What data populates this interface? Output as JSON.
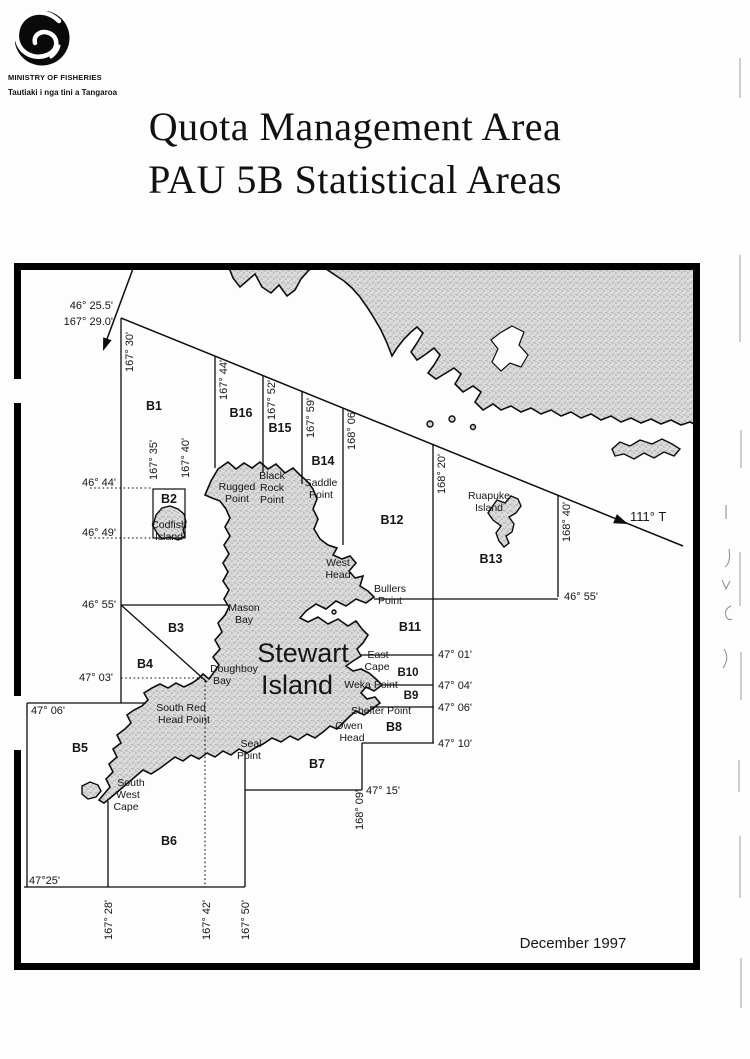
{
  "header": {
    "ministry": "MINISTRY OF FISHERIES",
    "tagline": "Tautiaki i nga tini a Tangaroa"
  },
  "title": {
    "line1": "Quota Management Area",
    "line2": "PAU 5B Statistical Areas"
  },
  "map": {
    "date": "December 1997",
    "bearing_label": "111° T",
    "origin_point": {
      "lat": "46° 25.5'",
      "lon": "167° 29.0'"
    },
    "island_title": "Stewart Island",
    "area_labels": [
      {
        "t": "B1",
        "x": 154,
        "y": 410
      },
      {
        "t": "B2",
        "x": 169,
        "y": 503
      },
      {
        "t": "B3",
        "x": 176,
        "y": 632
      },
      {
        "t": "B4",
        "x": 145,
        "y": 668
      },
      {
        "t": "B5",
        "x": 80,
        "y": 752
      },
      {
        "t": "B6",
        "x": 169,
        "y": 845
      },
      {
        "t": "B7",
        "x": 317,
        "y": 768
      },
      {
        "t": "B8",
        "x": 394,
        "y": 731
      },
      {
        "t": "B9",
        "x": 411,
        "y": 699,
        "size": 11.5
      },
      {
        "t": "B10",
        "x": 408,
        "y": 676,
        "size": 11.5
      },
      {
        "t": "B11",
        "x": 410,
        "y": 631
      },
      {
        "t": "B12",
        "x": 392,
        "y": 524
      },
      {
        "t": "B13",
        "x": 491,
        "y": 563
      },
      {
        "t": "B14",
        "x": 323,
        "y": 465
      },
      {
        "t": "B15",
        "x": 280,
        "y": 432
      },
      {
        "t": "B16",
        "x": 241,
        "y": 417
      }
    ],
    "coord_labels": [
      {
        "t": "46° 25.5'",
        "x": 113,
        "y": 309,
        "a": "end"
      },
      {
        "t": "167° 29.0'",
        "x": 113,
        "y": 325,
        "a": "end"
      },
      {
        "t": "167° 30'",
        "x": 133,
        "y": 372,
        "rot": -90
      },
      {
        "t": "167° 44'",
        "x": 227,
        "y": 400,
        "rot": -90
      },
      {
        "t": "167° 52'",
        "x": 275,
        "y": 420,
        "rot": -90
      },
      {
        "t": "167° 59'",
        "x": 314,
        "y": 438,
        "rot": -90
      },
      {
        "t": "168° 06'",
        "x": 355,
        "y": 450,
        "rot": -90
      },
      {
        "t": "168° 20'",
        "x": 445,
        "y": 494,
        "rot": -90
      },
      {
        "t": "168° 40'",
        "x": 570,
        "y": 542,
        "rot": -90
      },
      {
        "t": "167° 35'",
        "x": 157,
        "y": 480,
        "rot": -90
      },
      {
        "t": "167° 40'",
        "x": 189,
        "y": 478,
        "rot": -90
      },
      {
        "t": "46° 44'",
        "x": 116,
        "y": 486,
        "a": "end"
      },
      {
        "t": "46° 49'",
        "x": 116,
        "y": 536,
        "a": "end"
      },
      {
        "t": "46° 55'",
        "x": 116,
        "y": 608,
        "a": "end"
      },
      {
        "t": "47° 03'",
        "x": 113,
        "y": 681,
        "a": "end"
      },
      {
        "t": "47° 06'",
        "x": 31,
        "y": 714
      },
      {
        "t": "47°25'",
        "x": 29,
        "y": 884
      },
      {
        "t": "46° 55'",
        "x": 564,
        "y": 600
      },
      {
        "t": "47° 01'",
        "x": 438,
        "y": 658
      },
      {
        "t": "47° 04'",
        "x": 438,
        "y": 689
      },
      {
        "t": "47° 06'",
        "x": 438,
        "y": 711
      },
      {
        "t": "47° 10'",
        "x": 438,
        "y": 747
      },
      {
        "t": "47° 15'",
        "x": 366,
        "y": 794
      },
      {
        "t": "167° 28'",
        "x": 112,
        "y": 940,
        "rot": -90
      },
      {
        "t": "167° 42'",
        "x": 210,
        "y": 940,
        "rot": -90
      },
      {
        "t": "167° 50'",
        "x": 249,
        "y": 940,
        "rot": -90
      },
      {
        "t": "168° 09'",
        "x": 363,
        "y": 830,
        "rot": -90
      }
    ],
    "place_labels": [
      {
        "t": "Rugged",
        "x": 237,
        "y": 490
      },
      {
        "t": "Point",
        "x": 237,
        "y": 502
      },
      {
        "t": "Black",
        "x": 272,
        "y": 479
      },
      {
        "t": "Rock",
        "x": 272,
        "y": 491
      },
      {
        "t": "Point",
        "x": 272,
        "y": 503
      },
      {
        "t": "Saddle",
        "x": 321,
        "y": 486
      },
      {
        "t": "Point",
        "x": 321,
        "y": 498
      },
      {
        "t": "Ruapuke",
        "x": 489,
        "y": 499
      },
      {
        "t": "Island",
        "x": 489,
        "y": 511
      },
      {
        "t": "West",
        "x": 338,
        "y": 566
      },
      {
        "t": "Head",
        "x": 338,
        "y": 578
      },
      {
        "t": "Bullers",
        "x": 390,
        "y": 592
      },
      {
        "t": "Point",
        "x": 390,
        "y": 604
      },
      {
        "t": "Mason",
        "x": 244,
        "y": 611
      },
      {
        "t": "Bay",
        "x": 244,
        "y": 623
      },
      {
        "t": "Doughboy",
        "x": 234,
        "y": 672
      },
      {
        "t": "Bay",
        "x": 222,
        "y": 684
      },
      {
        "t": "East",
        "x": 378,
        "y": 658
      },
      {
        "t": "Cape",
        "x": 377,
        "y": 670
      },
      {
        "t": "Weka Point",
        "x": 371,
        "y": 688
      },
      {
        "t": "Shelter Point",
        "x": 381,
        "y": 714
      },
      {
        "t": "Owen",
        "x": 349,
        "y": 729
      },
      {
        "t": "Head",
        "x": 352,
        "y": 741
      },
      {
        "t": "Seal",
        "x": 251,
        "y": 747
      },
      {
        "t": "Point",
        "x": 249,
        "y": 759
      },
      {
        "t": "South Red",
        "x": 181,
        "y": 711
      },
      {
        "t": "Head Point",
        "x": 184,
        "y": 723
      },
      {
        "t": "South",
        "x": 131,
        "y": 786
      },
      {
        "t": "West",
        "x": 128,
        "y": 798
      },
      {
        "t": "Cape",
        "x": 126,
        "y": 810
      },
      {
        "t": "Codfish",
        "x": 169,
        "y": 528
      },
      {
        "t": "Island",
        "x": 169,
        "y": 540
      }
    ],
    "misc_labels": [
      {
        "t": "111° T",
        "x": 630,
        "y": 521,
        "size": 13
      },
      {
        "t": "December 1997",
        "x": 573,
        "y": 948,
        "a": "middle",
        "size": 15
      },
      {
        "t": "Stewart",
        "x": 303,
        "y": 662,
        "a": "middle",
        "size": 27
      },
      {
        "t": "Island",
        "x": 297,
        "y": 694,
        "a": "middle",
        "size": 27
      }
    ]
  }
}
